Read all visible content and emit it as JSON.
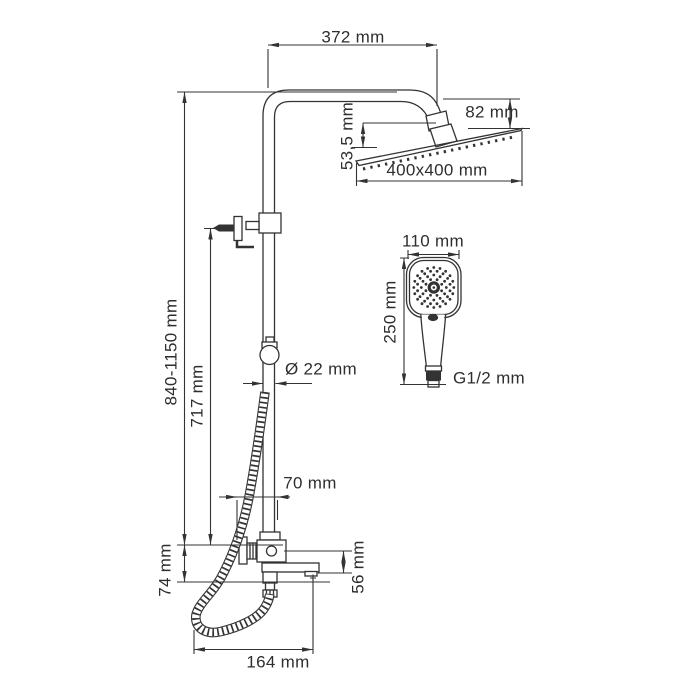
{
  "colors": {
    "line": "#333333",
    "background": "#ffffff"
  },
  "labels": {
    "top_width": "372 mm",
    "head_offset_vertical": "82 mm",
    "head_tilt": "53,5 mm",
    "overhead_size": "400x400 mm",
    "handshower_width": "110 mm",
    "handshower_length": "250 mm",
    "connection_thread": "G1/2 mm",
    "column_height_range": "840-1150 mm",
    "bracket_height": "717 mm",
    "pipe_diameter": "Ø 22 mm",
    "wall_offset": "70 mm",
    "mixer_drop": "74 mm",
    "spout_height": "56 mm",
    "spout_reach": "164 mm"
  }
}
